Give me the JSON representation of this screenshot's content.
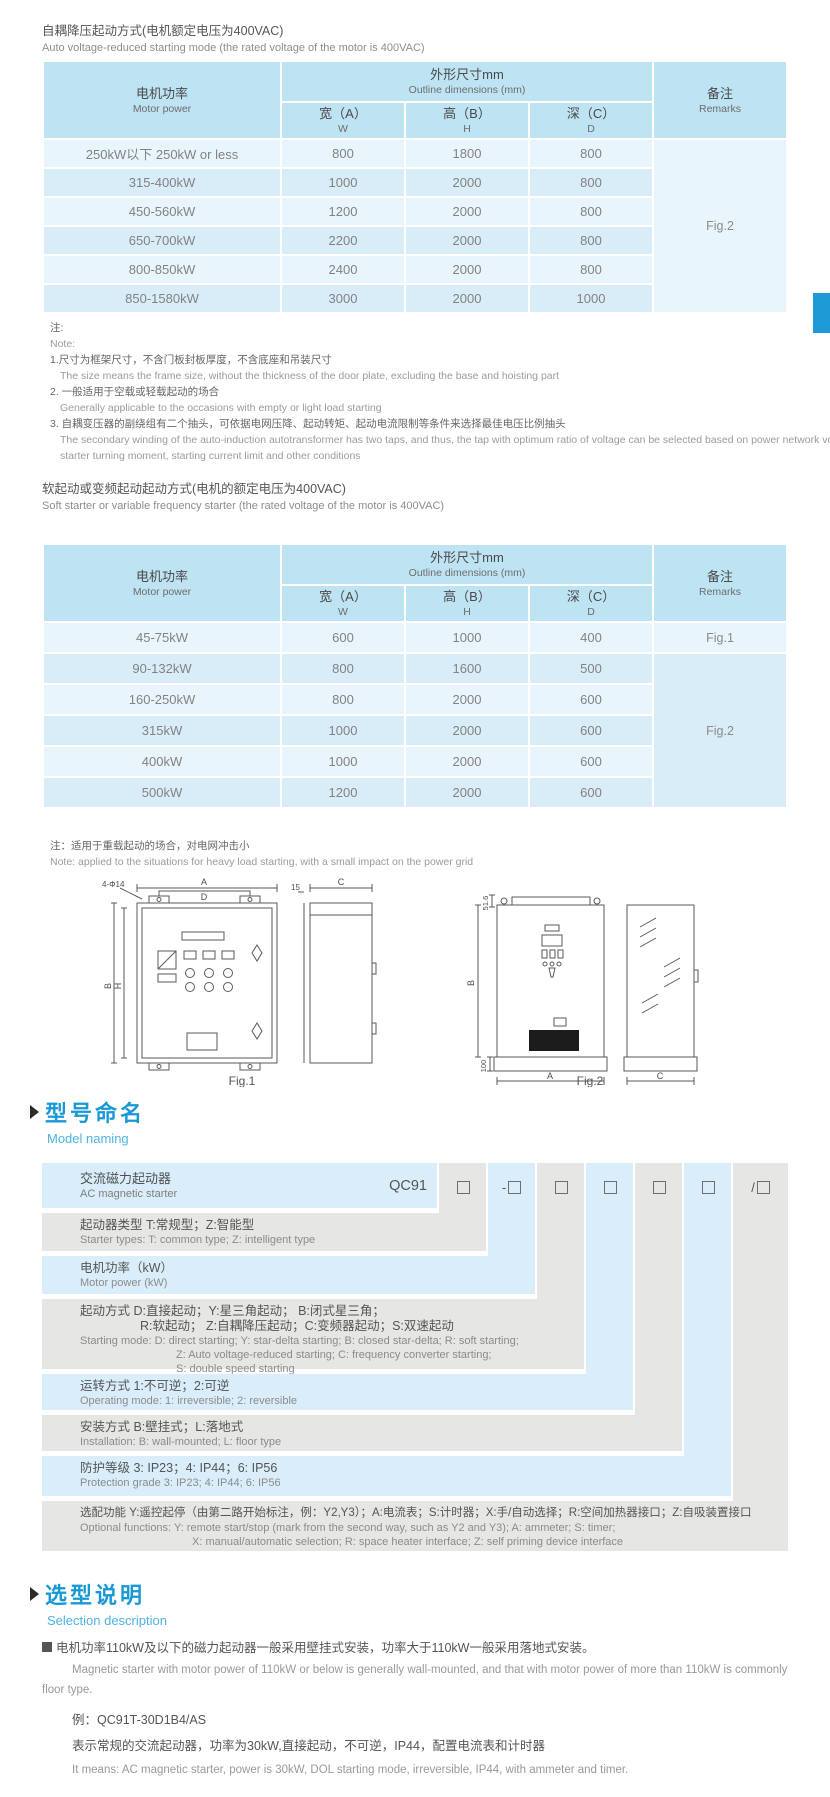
{
  "colors": {
    "accent_blue": "#1899d6",
    "header_bg": "#bee3f3",
    "row_light": "#e9f5fc",
    "row_mid": "#d9edf9",
    "band_blue": "#d9eefa",
    "band_gray": "#e6e6e4",
    "edge_tab": "#1e9bd7"
  },
  "section_auto": {
    "title_zh": "自耦降压起动方式(电机额定电压为400VAC)",
    "title_en": "Auto voltage-reduced starting mode (the rated voltage of the motor is 400VAC)",
    "table": {
      "header": {
        "motor_zh": "电机功率",
        "motor_en": "Motor power",
        "dims_zh": "外形尺寸mm",
        "dims_en": "Outline dimensions (mm)",
        "w_zh": "宽（A）",
        "w_en": "W",
        "h_zh": "高（B）",
        "h_en": "H",
        "d_zh": "深（C）",
        "d_en": "D",
        "remarks_zh": "备注",
        "remarks_en": "Remarks"
      },
      "rows": [
        {
          "power": "250kW以下 250kW or less",
          "w": "800",
          "h": "1800",
          "d": "800"
        },
        {
          "power": "315-400kW",
          "w": "1000",
          "h": "2000",
          "d": "800"
        },
        {
          "power": "450-560kW",
          "w": "1200",
          "h": "2000",
          "d": "800"
        },
        {
          "power": "650-700kW",
          "w": "2200",
          "h": "2000",
          "d": "800"
        },
        {
          "power": "800-850kW",
          "w": "2400",
          "h": "2000",
          "d": "800"
        },
        {
          "power": "850-1580kW",
          "w": "3000",
          "h": "2000",
          "d": "1000"
        }
      ],
      "remark": "Fig.2"
    },
    "notes": {
      "zh_label": "注:",
      "en_label": "Note:",
      "n1_zh": "1.尺寸为框架尺寸，不含门板封板厚度，不含底座和吊装尺寸",
      "n1_en": "The size means the frame size, without the thickness of the door plate, excluding the base and hoisting part",
      "n2_zh": "2. 一般适用于空载或轻载起动的场合",
      "n2_en": "Generally applicable to the occasions with empty or light load starting",
      "n3_zh": "3. 自耦变压器的副绕组有二个抽头，可依据电网压降、起动转矩、起动电流限制等条件来选择最佳电压比例抽头",
      "n3_en1": "The secondary winding of the auto-induction autotransformer has two taps, and thus, the tap with optimum ratio of voltage can be selected based on power network voltage drop,",
      "n3_en2": "starter turning moment, starting current limit and other conditions"
    }
  },
  "section_soft": {
    "title_zh": "软起动或变频起动起动方式(电机的额定电压为400VAC)",
    "title_en": "Soft starter or variable frequency starter (the rated voltage of the motor is 400VAC)",
    "table": {
      "header": {
        "motor_zh": "电机功率",
        "motor_en": "Motor power",
        "dims_zh": "外形尺寸mm",
        "dims_en": "Outline dimensions (mm)",
        "w_zh": "宽（A）",
        "w_en": "W",
        "h_zh": "高（B）",
        "h_en": "H",
        "d_zh": "深（C）",
        "d_en": "D",
        "remarks_zh": "备注",
        "remarks_en": "Remarks"
      },
      "rows": [
        {
          "power": "45-75kW",
          "w": "600",
          "h": "1000",
          "d": "400",
          "remark": "Fig.1"
        },
        {
          "power": "90-132kW",
          "w": "800",
          "h": "1600",
          "d": "500"
        },
        {
          "power": "160-250kW",
          "w": "800",
          "h": "2000",
          "d": "600"
        },
        {
          "power": "315kW",
          "w": "1000",
          "h": "2000",
          "d": "600"
        },
        {
          "power": "400kW",
          "w": "1000",
          "h": "2000",
          "d": "600"
        },
        {
          "power": "500kW",
          "w": "1200",
          "h": "2000",
          "d": "600"
        }
      ],
      "remark_span": "Fig.2"
    },
    "note_zh": "注：适用于重载起动的场合，对电网冲击小",
    "note_en": "Note: applied to the situations for heavy load starting, with a small impact on the power grid"
  },
  "figures": {
    "fig1_label": "Fig.1",
    "fig2_label": "Fig.2",
    "dims": {
      "a": "A",
      "b": "B",
      "c": "C",
      "d": "D",
      "h": "H",
      "holes": "4-Φ14",
      "off15": "15",
      "top516": "51.6",
      "bottom100": "100"
    }
  },
  "model_naming": {
    "heading_zh": "型号命名",
    "heading_en": "Model naming",
    "base_zh": "交流磁力起动器",
    "base_en": "AC magnetic starter",
    "code": "QC91",
    "prefixes": {
      "p1": "",
      "p2": "-",
      "p3": "",
      "p4": "",
      "p5": "",
      "p6": "",
      "p7": "/"
    },
    "rows": [
      {
        "zh": "起动器类型 T:常规型；Z:智能型",
        "en": "Starter types: T: common type; Z: intelligent type"
      },
      {
        "zh": "电机功率（kW）",
        "en": "Motor power (kW)"
      },
      {
        "zh": "起动方式 D:直接起动；Y:星三角起动；  B:闭式星三角；",
        "zh2": "R:软起动；  Z:自耦降压起动；C:变频器起动；S:双速起动",
        "en": "Starting mode: D: direct starting; Y: star-delta starting; B: closed star-delta; R: soft starting;",
        "en2": "Z: Auto voltage-reduced starting; C: frequency converter starting;",
        "en3": "S: double speed starting"
      },
      {
        "zh": "运转方式 1:不可逆；2:可逆",
        "en": "Operating mode: 1: irreversible; 2: reversible"
      },
      {
        "zh": "安装方式 B:壁挂式；L:落地式",
        "en": "Installation: B: wall-mounted; L: floor type"
      },
      {
        "zh": "防护等级 3: IP23；4: IP44；6: IP56",
        "en": "Protection grade  3: IP23; 4: IP44; 6: IP56"
      },
      {
        "zh": "选配功能 Y:遥控起停（由第二路开始标注，例：Y2,Y3）；A:电流表；S:计时器；X:手/自动选择；R:空间加热器接口；Z:自吸装置接口",
        "en": "Optional functions: Y: remote start/stop (mark from the second way, such as Y2 and Y3); A: ammeter; S: timer;",
        "en2": "X: manual/automatic selection; R: space heater interface; Z: self priming device interface"
      }
    ]
  },
  "selection": {
    "heading_zh": "选型说明",
    "heading_en": "Selection description",
    "bullet_zh": "电机功率110kW及以下的磁力起动器一般采用壁挂式安装，功率大于110kW一般采用落地式安装。",
    "body_en": "Magnetic starter with motor power of 110kW or below is generally wall-mounted, and that with motor power of more than 110kW is commonly floor type.",
    "example_label": "例：QC91T-30D1B4/AS",
    "example_zh": "表示常规的交流起动器，功率为30kW,直接起动，不可逆，IP44，配置电流表和计时器",
    "example_en": "It means: AC magnetic starter, power is 30kW, DOL starting mode, irreversible, IP44, with ammeter and timer."
  }
}
